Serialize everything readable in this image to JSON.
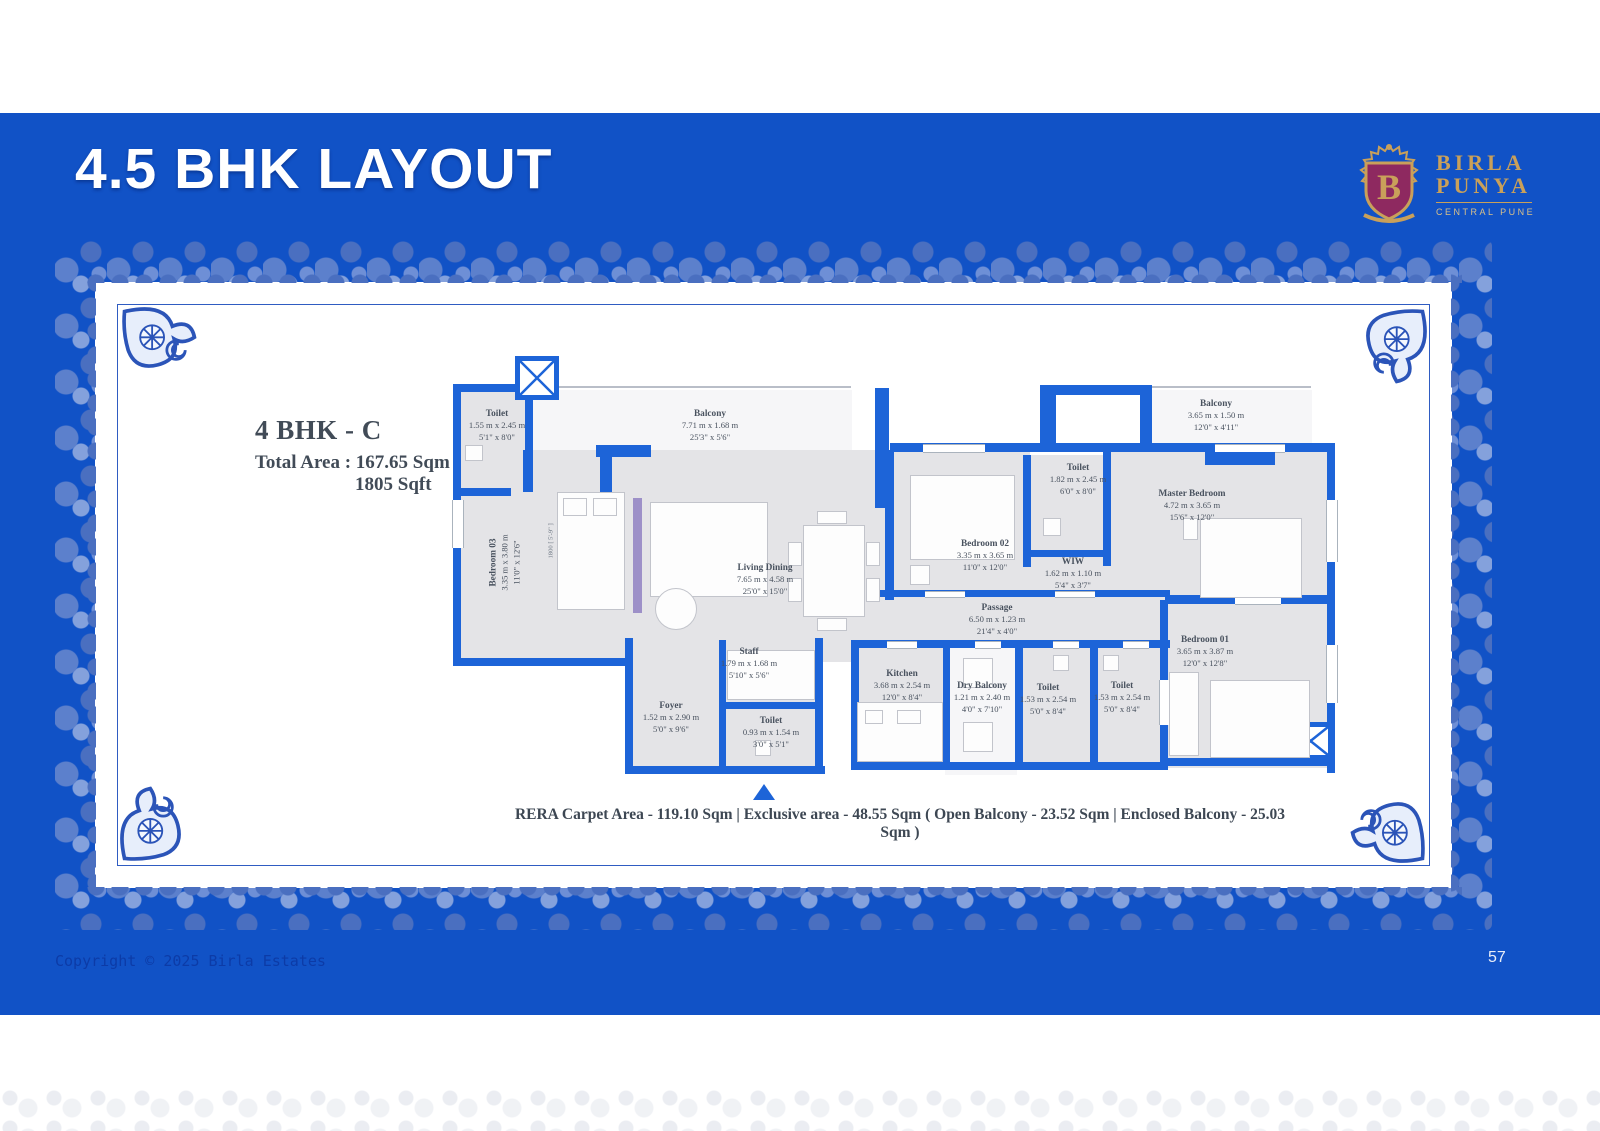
{
  "page": {
    "title": "4.5 BHK LAYOUT",
    "page_number": "57",
    "copyright": "Copyright © 2025 Birla Estates"
  },
  "logo": {
    "monogram": "B",
    "brand_line1": "BIRLA",
    "brand_line2": "PUNYA",
    "tagline": "CENTRAL PUNE"
  },
  "plan_info": {
    "unit_name": "4 BHK - C",
    "total_area_line": "Total Area :  167.65 Sqm",
    "total_area_sqft": "1805 Sqft"
  },
  "footer_note": "RERA Carpet Area - 119.10 Sqm | Exclusive area - 48.55 Sqm ( Open Balcony - 23.52 Sqm | Enclosed Balcony - 25.03 Sqm )",
  "floorplan": {
    "bed_tag": "1800 [ 5'-9\" ]",
    "rooms": {
      "toilet_entry": {
        "name": "Toilet",
        "metric": "1.55 m x 2.45 m",
        "imperial": "5'1\" x 8'0\""
      },
      "balcony_main": {
        "name": "Balcony",
        "metric": "7.71 m x 1.68 m",
        "imperial": "25'3\" x 5'6\""
      },
      "bedroom_03": {
        "name": "Bedroom 03",
        "metric": "3.35 m x 3.80 m",
        "imperial": "11'0\" x 12'6\""
      },
      "living_dining": {
        "name": "Living Dining",
        "metric": "7.65 m x 4.58 m",
        "imperial": "25'0\" x 15'0\""
      },
      "bedroom_02": {
        "name": "Bedroom 02",
        "metric": "3.35 m x 3.65 m",
        "imperial": "11'0\" x 12'0\""
      },
      "toilet_master": {
        "name": "Toilet",
        "metric": "1.82 m x 2.45 m",
        "imperial": "6'0\" x 8'0\""
      },
      "wiw": {
        "name": "WIW",
        "metric": "1.62 m x 1.10 m",
        "imperial": "5'4\" x 3'7\""
      },
      "balcony_master": {
        "name": "Balcony",
        "metric": "3.65 m x 1.50 m",
        "imperial": "12'0\" x 4'11\""
      },
      "master_bedroom": {
        "name": "Master Bedroom",
        "metric": "4.72 m x 3.65 m",
        "imperial": "15'6\" x 12'0\""
      },
      "passage": {
        "name": "Passage",
        "metric": "6.50 m x 1.23 m",
        "imperial": "21'4\" x 4'0\""
      },
      "bedroom_01": {
        "name": "Bedroom 01",
        "metric": "3.65 m x 3.87 m",
        "imperial": "12'0\" x 12'8\""
      },
      "staff": {
        "name": "Staff",
        "metric": "1.79 m x 1.68 m",
        "imperial": "5'10\" x 5'6\""
      },
      "foyer": {
        "name": "Foyer",
        "metric": "1.52 m x 2.90 m",
        "imperial": "5'0\" x 9'6\""
      },
      "toilet_staff": {
        "name": "Toilet",
        "metric": "0.93 m x 1.54 m",
        "imperial": "3'0\" x 5'1\""
      },
      "kitchen": {
        "name": "Kitchen",
        "metric": "3.68 m x 2.54 m",
        "imperial": "12'0\" x 8'4\""
      },
      "dry_balcony": {
        "name": "Dry Balcony",
        "metric": "1.21 m x 2.40 m",
        "imperial": "4'0\" x 7'10\""
      },
      "toilet_03": {
        "name": "Toilet",
        "metric": "1.53 m x 2.54 m",
        "imperial": "5'0\" x 8'4\""
      },
      "toilet_01": {
        "name": "Toilet",
        "metric": "1.53 m x 2.54 m",
        "imperial": "5'0\" x 8'4\""
      }
    }
  },
  "colors": {
    "page_blue": "#1152c6",
    "wall_blue": "#1d64d8",
    "gold": "#c9a05a",
    "crest_maroon": "#8e2960",
    "floor_gray": "#e4e4e7",
    "label_text": "#49525f"
  }
}
